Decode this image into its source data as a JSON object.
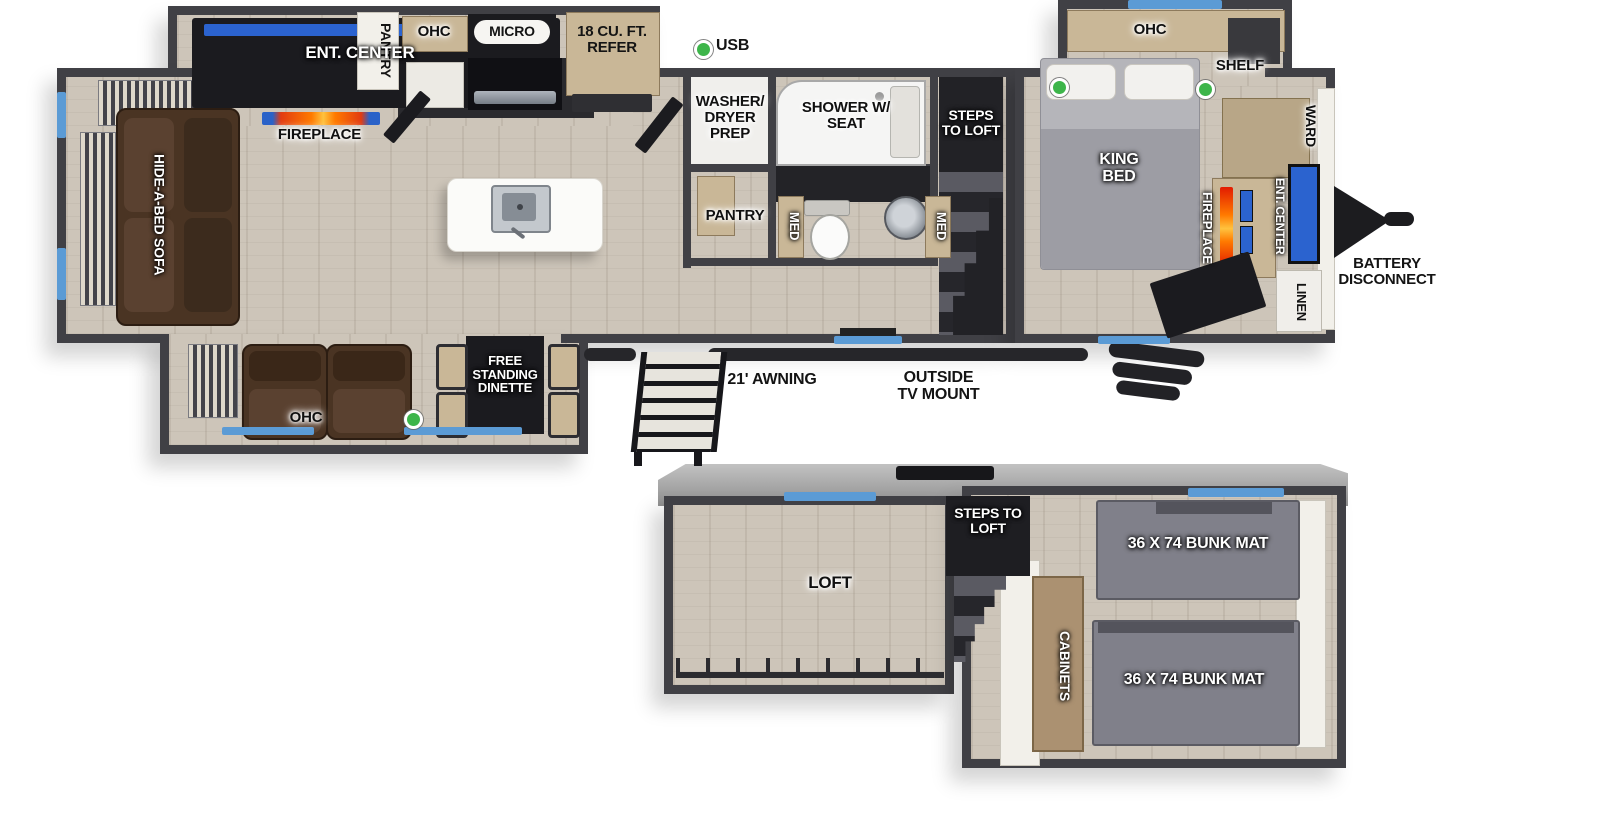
{
  "colors": {
    "wall": "#404045",
    "floor": "#cdc5b9",
    "window": "#5b9bd5",
    "usb": "#3db54a",
    "tv": "#2b63cf",
    "tan": "#c9b797",
    "brown": "#4a3423",
    "mat": "#80808a",
    "dark": "#1b1b1f",
    "white_wall": "#f2f0ea",
    "roof": "#a9a9a9"
  },
  "main_floor": {
    "rear_living": {
      "ent_center": "ENT. CENTER",
      "fireplace": "FIREPLACE",
      "sofa": "HIDE-A-BED SOFA"
    },
    "kitchen": {
      "pantry": "PANTRY",
      "ohc": "OHC",
      "micro": "MICRO",
      "refer": "18 CU. FT. REFER",
      "usb": "USB"
    },
    "bath": {
      "washer_dryer": "WASHER/ DRYER PREP",
      "shower": "SHOWER W/ SEAT",
      "pantry": "PANTRY",
      "med_left": "MED",
      "med_right": "MED"
    },
    "steps_to_loft": "STEPS TO LOFT",
    "bedroom": {
      "ohc": "OHC",
      "shelf": "SHELF",
      "king_bed": "KING BED",
      "fireplace": "FIREPLACE",
      "ent_center": "ENT. CENTER",
      "ward": "WARD",
      "linen": "LINEN"
    },
    "door_side": {
      "ohc": "OHC",
      "dinette": "FREE STANDING DINETTE"
    },
    "exterior": {
      "battery_disconnect": "BATTERY DISCONNECT",
      "awning": "21' AWNING",
      "tv_mount": "OUTSIDE TV MOUNT"
    }
  },
  "loft_level": {
    "loft": "LOFT",
    "steps_to_loft": "STEPS TO LOFT",
    "cabinets": "CABINETS",
    "bunk_top": "36 X 74 BUNK MAT",
    "bunk_bottom": "36 X 74 BUNK MAT"
  }
}
